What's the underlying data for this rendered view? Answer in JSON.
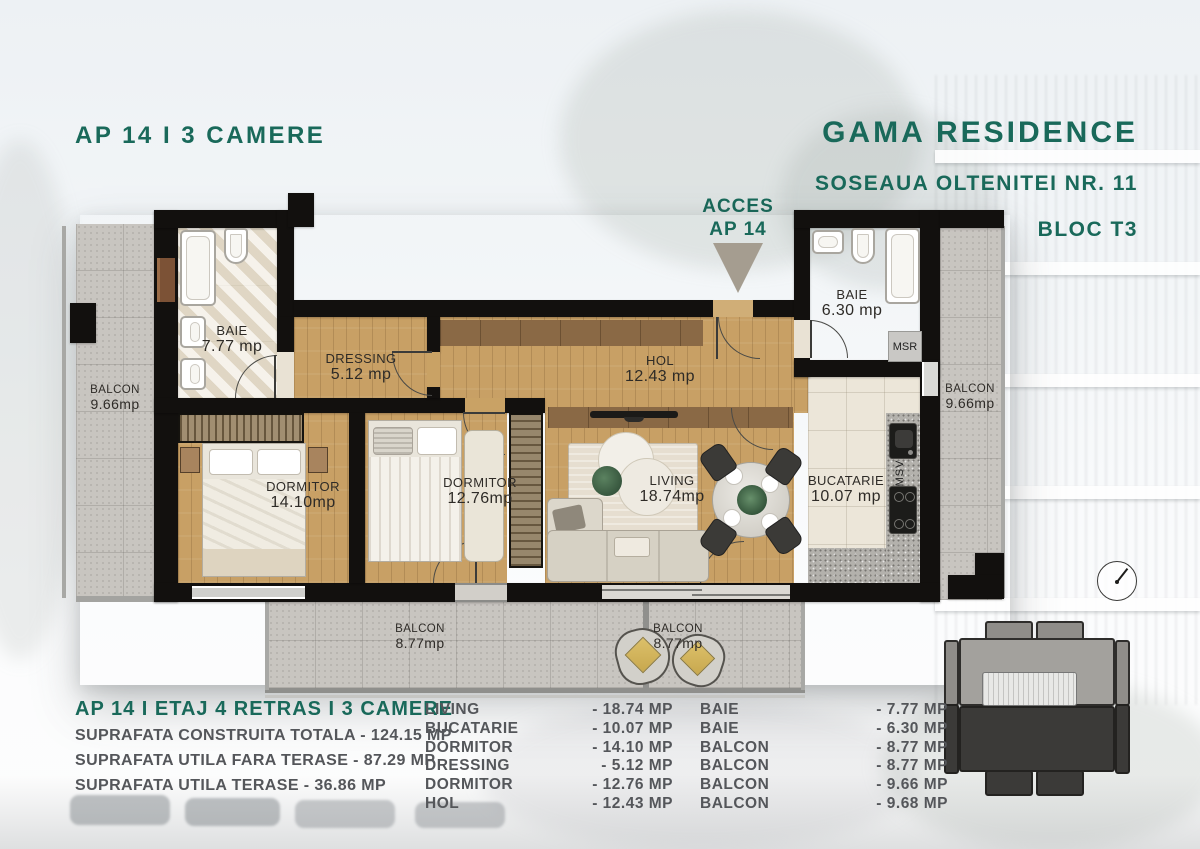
{
  "header": {
    "apartment_title": "AP 14 I 3 CAMERE",
    "project_name": "GAMA RESIDENCE",
    "address": "SOSEAUA OLTENITEI NR. 11",
    "block": "BLOC T3"
  },
  "access": {
    "line1": "ACCES",
    "line2": "AP 14"
  },
  "plan": {
    "rooms": {
      "balcon_left": {
        "name": "BALCON",
        "area": "9.66mp"
      },
      "baie_1": {
        "name": "BAIE",
        "area": "7.77 mp"
      },
      "dressing": {
        "name": "DRESSING",
        "area": "5.12 mp"
      },
      "hol": {
        "name": "HOL",
        "area": "12.43 mp"
      },
      "baie_2": {
        "name": "BAIE",
        "area": "6.30 mp"
      },
      "balcon_right": {
        "name": "BALCON",
        "area": "9.66mp"
      },
      "dormitor_1": {
        "name": "DORMITOR",
        "area": "14.10mp"
      },
      "dormitor_2": {
        "name": "DORMITOR",
        "area": "12.76mp"
      },
      "living": {
        "name": "LIVING",
        "area": "18.74mp"
      },
      "bucatarie": {
        "name": "BUCATARIE",
        "area": "10.07 mp"
      },
      "balcon_bottom_left": {
        "name": "BALCON",
        "area": "8.77mp"
      },
      "balcon_bottom_right": {
        "name": "BALCON",
        "area": "8.77mp"
      }
    },
    "annotations": {
      "msr": "MSR",
      "msv": "MSV"
    }
  },
  "summary": {
    "title": "AP 14 I ETAJ 4 RETRAS I 3 CAMERE",
    "lines": [
      "SUPRAFATA CONSTRUITA TOTALA - 124.15 MP",
      "SUPRAFATA UTILA FARA TERASE - 87.29 MP",
      "SUPRAFATA UTILA TERASE - 36.86 MP"
    ]
  },
  "area_table": {
    "left": [
      {
        "label": "LIVING",
        "value": "- 18.74 MP"
      },
      {
        "label": "BUCATARIE",
        "value": "- 10.07 MP"
      },
      {
        "label": "DORMITOR",
        "value": "- 14.10 MP"
      },
      {
        "label": "DRESSING",
        "value": "- 5.12 MP"
      },
      {
        "label": "DORMITOR",
        "value": "- 12.76 MP"
      },
      {
        "label": "HOL",
        "value": "- 12.43 MP"
      }
    ],
    "right": [
      {
        "label": "BAIE",
        "value": "- 7.77 MP"
      },
      {
        "label": "BAIE",
        "value": "- 6.30 MP"
      },
      {
        "label": "BALCON",
        "value": "- 8.77 MP"
      },
      {
        "label": "BALCON",
        "value": "- 8.77 MP"
      },
      {
        "label": "BALCON",
        "value": "- 9.66 MP"
      },
      {
        "label": "BALCON",
        "value": "- 9.68 MP"
      }
    ]
  },
  "colors": {
    "accent_teal": "#19695A",
    "text_gray": "#54565A",
    "wall_black": "#12100E"
  }
}
